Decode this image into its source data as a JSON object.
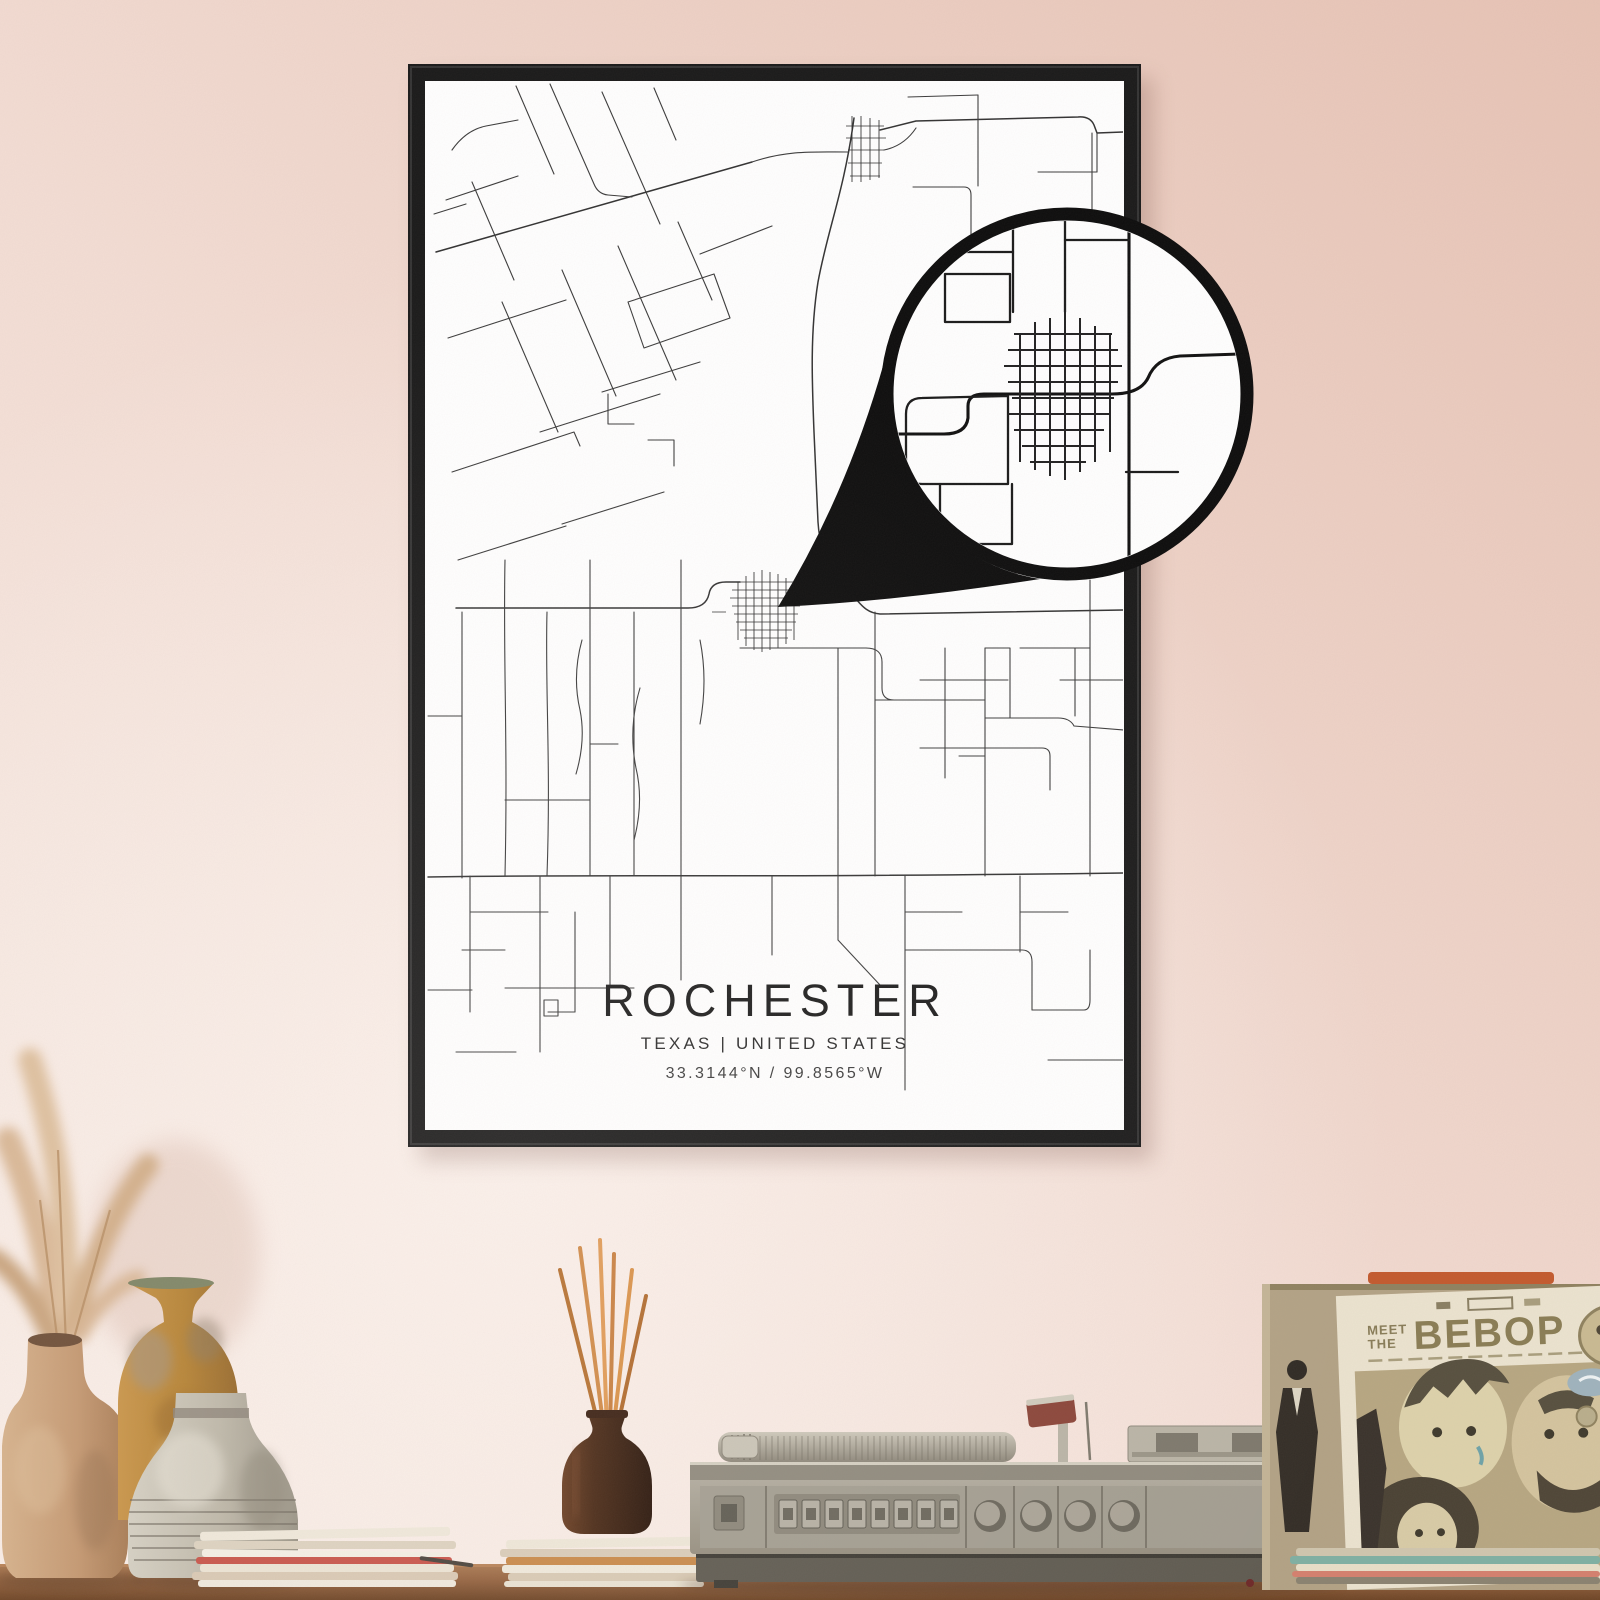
{
  "poster": {
    "title": "ROCHESTER",
    "subtitle": "TEXAS | UNITED STATES",
    "coordinates": "33.3144°N / 99.8565°W"
  },
  "album": {
    "meet": "MEET",
    "the": "THE",
    "bebop": "BEBOP"
  },
  "colors": {
    "wall_top_right": "#e7c3b5",
    "wall_bottom_left": "#f8ece5",
    "frame": "#1a1a1a",
    "poster_background": "#ffffff",
    "road_ink": "#3c3c3c",
    "callout_ink": "#0d0d0d",
    "table_wood": "#9a6b4a",
    "reed_sticks": "#d08a47",
    "diffuser_glass": "#432818",
    "album_ink": "#8a7d55",
    "turntable_body": "#a8a396",
    "vase_tan": "#c9a17e",
    "vase_ochre": "#bd8a3e",
    "vase_gray": "#c2bcae"
  }
}
